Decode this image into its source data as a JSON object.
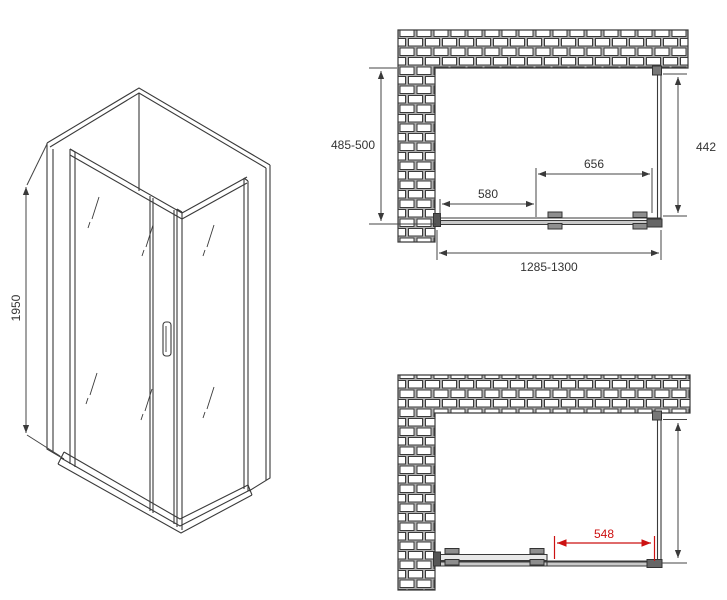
{
  "colors": {
    "line": "#3a3a3a",
    "dimension_line": "#444444",
    "accent_red": "#cc1111",
    "brick_mortar": "#aeaeae",
    "metal_gray": "#666666"
  },
  "iso_view": {
    "height_dim": "1950"
  },
  "top_view": {
    "depth_dim": "485-500",
    "side_panel_dim": "442",
    "door_dim": "656",
    "fixed_panel_dim": "580",
    "width_dim": "1285-1300"
  },
  "bottom_view": {
    "opening_dim": "548"
  }
}
